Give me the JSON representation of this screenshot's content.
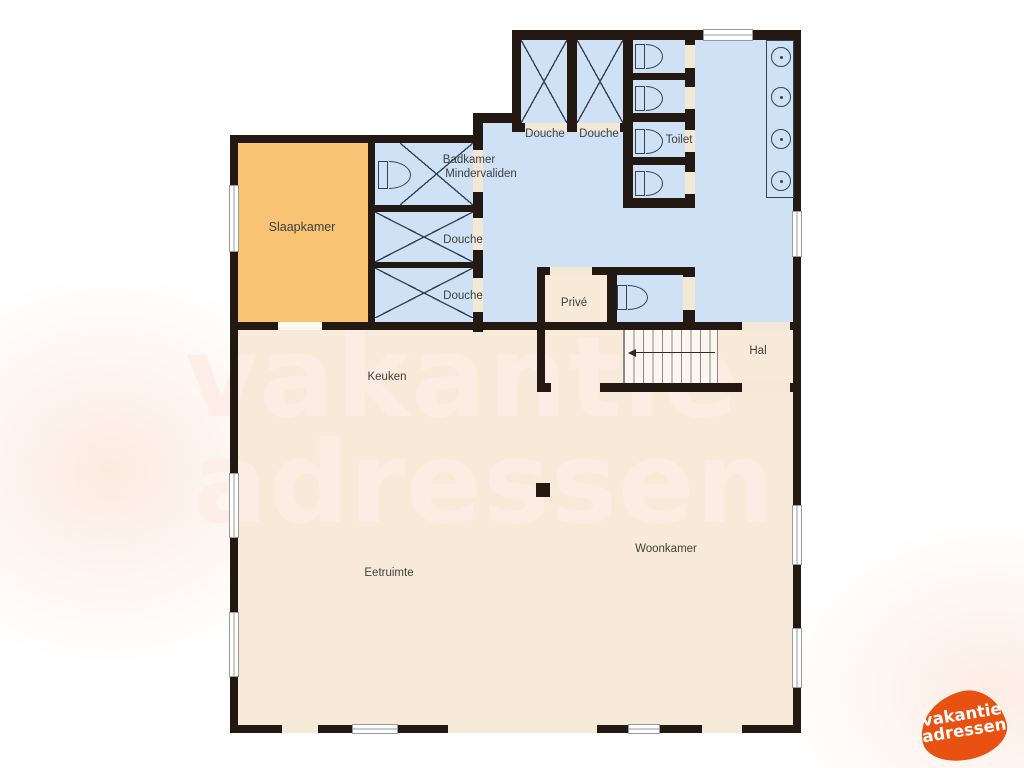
{
  "watermark": {
    "line1": "vakantie",
    "line2": "adressen"
  },
  "brand_logo": {
    "line1": "vakantie",
    "line2": "adressen"
  },
  "rooms": {
    "slaapkamer": {
      "label": "Slaapkamer"
    },
    "badkamer_mindervaliden": {
      "line1": "Badkamer",
      "line2": "Mindervaliden"
    },
    "douche_top_1": {
      "label": "Douche"
    },
    "douche_top_2": {
      "label": "Douche"
    },
    "toilet": {
      "label": "Toilet"
    },
    "douche_left_1": {
      "label": "Douche"
    },
    "douche_left_2": {
      "label": "Douche"
    },
    "prive": {
      "label": "Privé"
    },
    "hal": {
      "label": "Hal"
    },
    "keuken": {
      "label": "Keuken"
    },
    "eetruimte": {
      "label": "Eetruimte"
    },
    "woonkamer": {
      "label": "Woonkamer"
    }
  },
  "colors": {
    "wall": "#241812",
    "bedroom_floor": "#f9c374",
    "wet_floor": "#cfe1f5",
    "living_floor": "#f8ead9",
    "door_opening": "#f5e7d6",
    "fixture_line": "#31445c",
    "stair_line": "#8a8a8a",
    "label_text": "#3f3f3f",
    "watermark": "#fdeee6",
    "logo_orange": "#e85112"
  }
}
